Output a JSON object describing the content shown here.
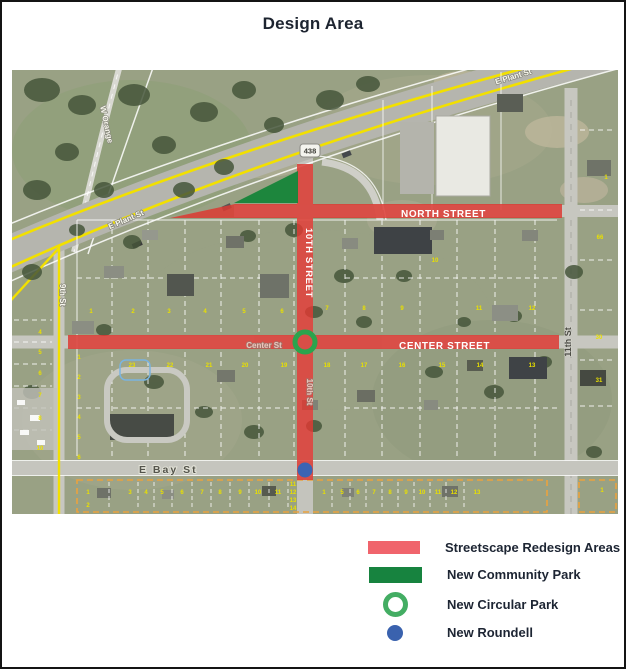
{
  "title": "Design Area",
  "legend": {
    "items": [
      {
        "id": "streetscape",
        "label": "Streetscape Redesign Areas",
        "swatch": "rect",
        "color": "#f0646c"
      },
      {
        "id": "community-park",
        "label": "New Community Park",
        "swatch": "rect",
        "color": "#17833f"
      },
      {
        "id": "circular-park",
        "label": "New Circular Park",
        "swatch": "ring",
        "color": "#43ad63"
      },
      {
        "id": "roundell",
        "label": "New Roundell",
        "swatch": "dot",
        "color": "#3a62ae"
      }
    ]
  },
  "map": {
    "route_shield": "438",
    "overlay_colors": {
      "streetscape_red": "#dc3a32",
      "park_green": "#168539",
      "ring_green": "#2aa44d",
      "roundell_blue": "#3b64b3"
    },
    "street_labels": [
      {
        "id": "north-street",
        "text": "NORTH STREET",
        "x": 389,
        "y": 147,
        "cls": "overlay"
      },
      {
        "id": "center-street",
        "text": "CENTER STREET",
        "x": 387,
        "y": 279,
        "cls": "overlay"
      },
      {
        "id": "tenth-street-overlay",
        "text": "10TH STREET",
        "x": 294,
        "y": 193,
        "rotate": 90,
        "cls": "overlay-v"
      },
      {
        "id": "e-plant-st-west",
        "text": "E Plant St",
        "x": 115,
        "y": 152,
        "rotate": -23,
        "cls": "minor"
      },
      {
        "id": "e-plant-st-east",
        "text": "E Plant St",
        "x": 502,
        "y": 9,
        "rotate": -17,
        "cls": "minor"
      },
      {
        "id": "w-orange-st",
        "text": "W Orange",
        "x": 92,
        "y": 55,
        "rotate": 78,
        "cls": "minor"
      },
      {
        "id": "ninth-st",
        "text": "9th St",
        "x": 48,
        "y": 225,
        "rotate": 90,
        "cls": "minor"
      },
      {
        "id": "tenth-st-painted",
        "text": "10th St",
        "x": 295,
        "y": 322,
        "rotate": 90,
        "cls": "minor faint"
      },
      {
        "id": "center-st-painted",
        "text": "Center St",
        "x": 252,
        "y": 278,
        "cls": "minor faint"
      },
      {
        "id": "eleventh-st",
        "text": "11th St",
        "x": 559,
        "y": 272,
        "rotate": -90,
        "cls": "dark"
      },
      {
        "id": "e-bay-st",
        "text": "E Bay St",
        "x": 127,
        "y": 403,
        "cls": "bay"
      }
    ],
    "lot_numbers": [
      [
        28,
        264,
        "4"
      ],
      [
        28,
        284,
        "5"
      ],
      [
        28,
        305,
        "6"
      ],
      [
        28,
        327,
        "7"
      ],
      [
        28,
        350,
        "8"
      ],
      [
        28,
        380,
        "10"
      ],
      [
        67,
        289,
        "1"
      ],
      [
        67,
        309,
        "2"
      ],
      [
        67,
        329,
        "3"
      ],
      [
        67,
        349,
        "4"
      ],
      [
        67,
        369,
        "5"
      ],
      [
        67,
        389,
        "6"
      ],
      [
        79,
        243,
        "1"
      ],
      [
        121,
        243,
        "2"
      ],
      [
        157,
        243,
        "3"
      ],
      [
        193,
        243,
        "4"
      ],
      [
        232,
        243,
        "5"
      ],
      [
        270,
        243,
        "6"
      ],
      [
        423,
        192,
        "10"
      ],
      [
        315,
        240,
        "7"
      ],
      [
        352,
        240,
        "8"
      ],
      [
        390,
        240,
        "9"
      ],
      [
        467,
        240,
        "11"
      ],
      [
        520,
        240,
        "12"
      ],
      [
        120,
        297,
        "23"
      ],
      [
        158,
        297,
        "22"
      ],
      [
        197,
        297,
        "21"
      ],
      [
        233,
        297,
        "20"
      ],
      [
        272,
        297,
        "19"
      ],
      [
        315,
        297,
        "18"
      ],
      [
        352,
        297,
        "17"
      ],
      [
        390,
        297,
        "16"
      ],
      [
        430,
        297,
        "15"
      ],
      [
        468,
        297,
        "14"
      ],
      [
        520,
        297,
        "13"
      ],
      [
        594,
        109,
        "1"
      ],
      [
        588,
        169,
        "66"
      ],
      [
        587,
        269,
        "30"
      ],
      [
        587,
        312,
        "31"
      ],
      [
        76,
        424,
        "1"
      ],
      [
        76,
        437,
        "2"
      ],
      [
        118,
        424,
        "3"
      ],
      [
        134,
        424,
        "4"
      ],
      [
        150,
        424,
        "5"
      ],
      [
        170,
        424,
        "6"
      ],
      [
        190,
        424,
        "7"
      ],
      [
        208,
        424,
        "8"
      ],
      [
        228,
        424,
        "9"
      ],
      [
        246,
        424,
        "10"
      ],
      [
        266,
        424,
        "11"
      ],
      [
        281,
        416,
        "11"
      ],
      [
        281,
        424,
        "12"
      ],
      [
        281,
        432,
        "13"
      ],
      [
        281,
        440,
        "14"
      ],
      [
        312,
        424,
        "1"
      ],
      [
        330,
        424,
        "5"
      ],
      [
        346,
        424,
        "6"
      ],
      [
        362,
        424,
        "7"
      ],
      [
        378,
        424,
        "8"
      ],
      [
        394,
        424,
        "9"
      ],
      [
        410,
        424,
        "10"
      ],
      [
        426,
        424,
        "11"
      ],
      [
        442,
        424,
        "12"
      ],
      [
        465,
        424,
        "13"
      ],
      [
        590,
        422,
        "1"
      ]
    ]
  }
}
